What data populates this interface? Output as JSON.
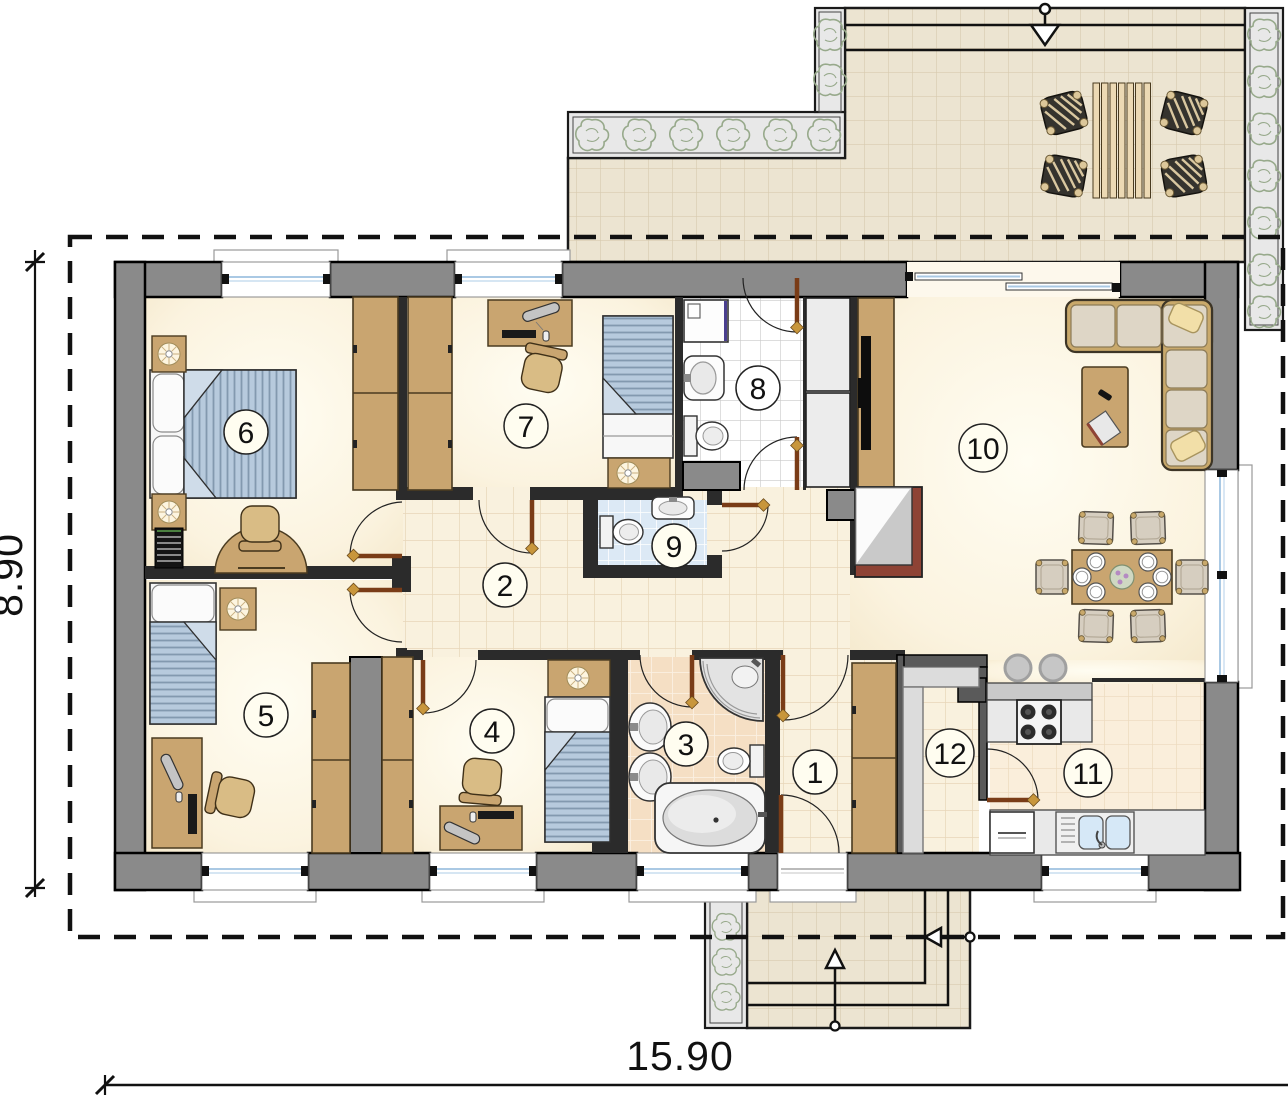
{
  "drawing": {
    "type": "architectural-floor-plan",
    "rooms": [
      {
        "number": "1",
        "kind": "entrance-hall"
      },
      {
        "number": "2",
        "kind": "hallway"
      },
      {
        "number": "3",
        "kind": "bathroom"
      },
      {
        "number": "4",
        "kind": "bedroom"
      },
      {
        "number": "5",
        "kind": "bedroom"
      },
      {
        "number": "6",
        "kind": "bedroom"
      },
      {
        "number": "7",
        "kind": "bedroom"
      },
      {
        "number": "8",
        "kind": "bathroom-laundry"
      },
      {
        "number": "9",
        "kind": "wc"
      },
      {
        "number": "10",
        "kind": "living-room"
      },
      {
        "number": "11",
        "kind": "kitchen"
      },
      {
        "number": "12",
        "kind": "pantry"
      }
    ],
    "dimensions": {
      "width": "15.90",
      "height": "8.90"
    },
    "colors": {
      "wall_gray": "#8a8a8a",
      "interior_wall": "#2b2b2b",
      "floor_cream": "#fbf3df",
      "hall_tile": "#f8efdc",
      "terrace_tile": "#ece4d1",
      "white_tile": "#ffffff",
      "blue_tile": "#dce9f5",
      "peach_tile": "#f5dfc4",
      "wood_tan": "#c9a570",
      "bed_fabric_blue": "#b7cadd",
      "door_leaf_brown": "#7a3c17",
      "plant_green": "#97a98b",
      "fireplace_brick": "#8e4335"
    }
  }
}
